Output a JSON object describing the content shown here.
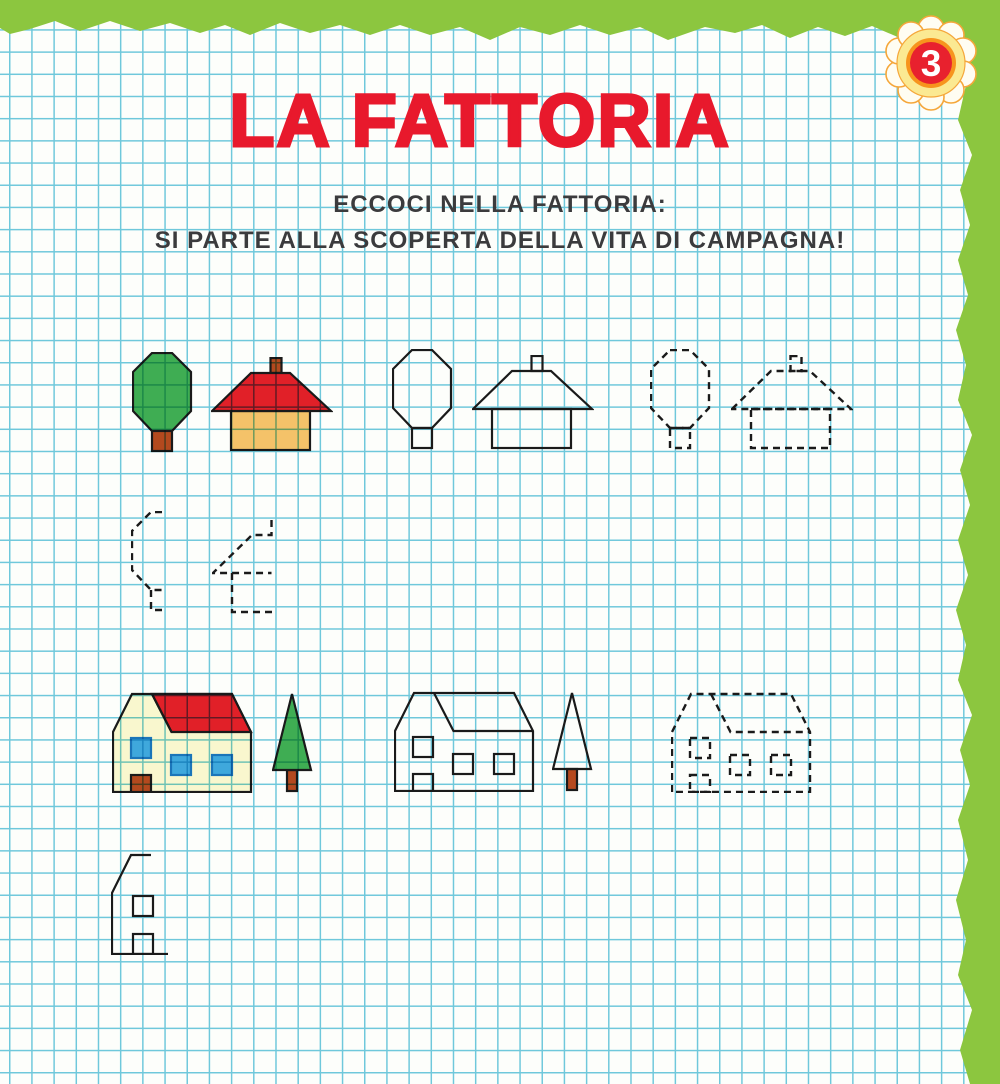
{
  "page": {
    "badge_number": "3",
    "title": "LA FATTORIA",
    "subtitle_line1": "ECCOCI NELLA FATTORIA:",
    "subtitle_line2": "SI PARTE ALLA SCOPERTA DELLA VITA DI CAMPAGNA!"
  },
  "palette": {
    "border_green": "#8cc63f",
    "paper": "#fdfefb",
    "grid_blue": "#6fc8db",
    "title_red": "#e8192c",
    "text_dark": "#3b3b3d",
    "outline_black": "#1a1a1a",
    "tree_green": "#3fae54",
    "trunk_brown": "#b5491e",
    "roof_red": "#e32028",
    "house_tan": "#f6c36b",
    "house_cream": "#fbf8d2",
    "window_blue": "#3fa9e0",
    "window_border": "#1b75bc",
    "flower_petal": "#fffdf2",
    "flower_petal_border": "#f5a73b",
    "flower_yellow": "#fbe992",
    "flower_orange": "#f7941d",
    "flower_red": "#e8212e"
  },
  "figures": {
    "row1": [
      "tree-colored-icon",
      "house-colored-icon",
      "tree-outline-icon",
      "house-outline-icon",
      "tree-dashed-icon",
      "house-dashed-icon"
    ],
    "row2": [
      "tree-trace-partial-icon",
      "house-trace-partial-icon"
    ],
    "row3": [
      "cottage-colored-icon",
      "pine-colored-icon",
      "cottage-outline-icon",
      "pine-outline-icon",
      "cottage-dashed-icon"
    ],
    "row4": [
      "cottage-trace-partial-icon"
    ]
  }
}
